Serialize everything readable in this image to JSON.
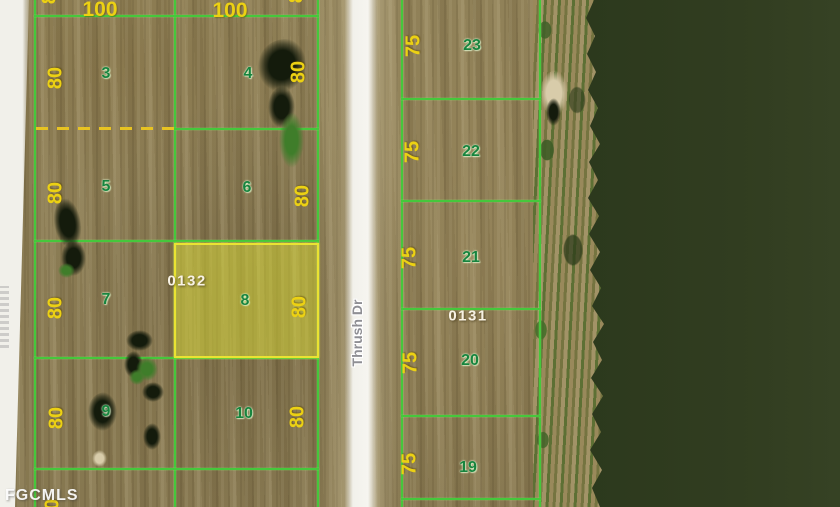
{
  "watermark": "FGCMLS",
  "road": {
    "name": "Thrush Dr"
  },
  "block_ids": {
    "left": "0132",
    "right": "0131"
  },
  "top_dims": [
    "100",
    "100"
  ],
  "left_lots": [
    {
      "n": "3",
      "dim": "80"
    },
    {
      "n": "4",
      "dim": "80"
    },
    {
      "n": "5",
      "dim": "80"
    },
    {
      "n": "6",
      "dim": "80"
    },
    {
      "n": "7",
      "dim": "80"
    },
    {
      "n": "8",
      "dim": "80"
    },
    {
      "n": "9",
      "dim": "80"
    },
    {
      "n": "10",
      "dim": "80"
    }
  ],
  "right_lots": [
    {
      "n": "23",
      "dim": "75"
    },
    {
      "n": "22",
      "dim": "75"
    },
    {
      "n": "21",
      "dim": "75"
    },
    {
      "n": "20",
      "dim": "75"
    },
    {
      "n": "19",
      "dim": "75"
    }
  ],
  "partial_dims": {
    "top_left": "80",
    "top_right": "80",
    "bottom_left": "80"
  },
  "highlight": {
    "lot": "8"
  },
  "colors": {
    "lot_line": "#46c73c",
    "dimension_text": "#ecd113",
    "lot_number_text": "#17843e",
    "highlight_fill": "#eae332",
    "block_id_text": "#f8f2e4",
    "water": "#2c391d"
  }
}
